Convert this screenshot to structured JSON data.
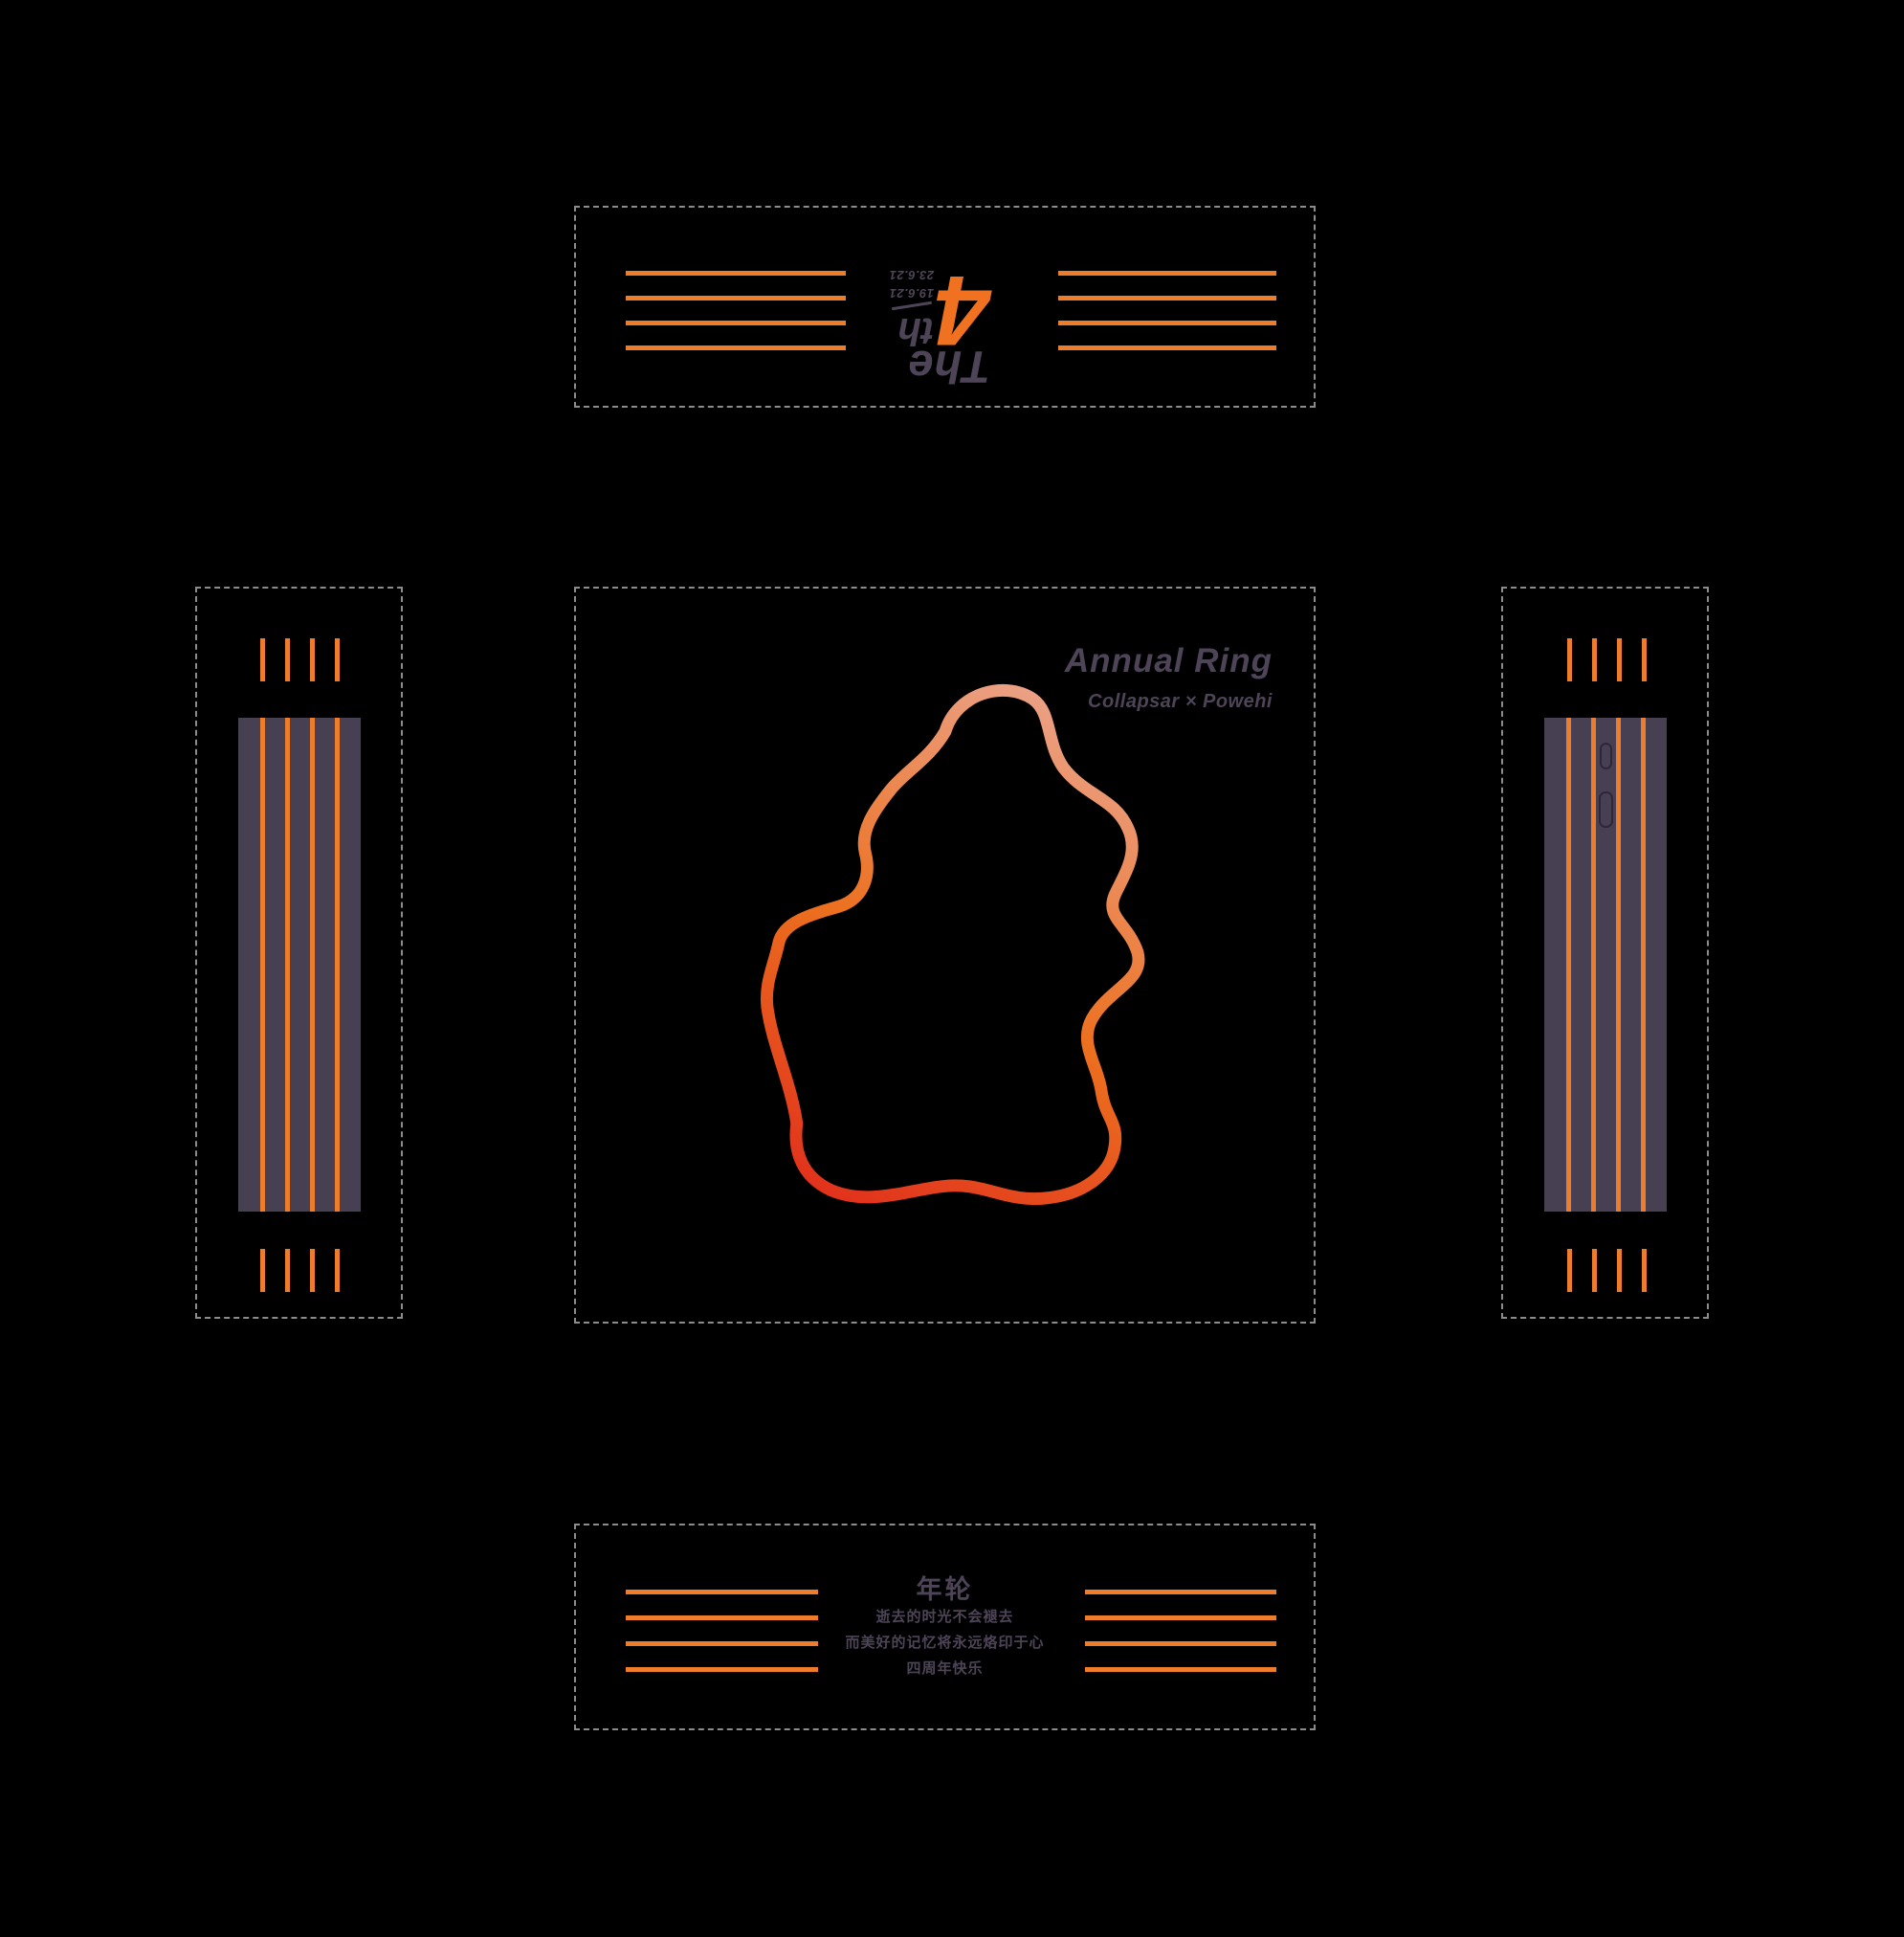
{
  "artwork": {
    "title": "Annual Ring",
    "subtitle": "Collapsar × Powehi"
  },
  "brand_flap": {
    "word": "The",
    "number": "4",
    "ordinal_suffix": "th",
    "date_from": "19.6.21",
    "date_to": "23.6.21"
  },
  "message_flap": {
    "title": "年轮",
    "lines": [
      "逝去的时光不会褪去",
      "而美好的记忆将永远烙印于心",
      "四周年快乐"
    ]
  },
  "colors": {
    "background": "#000000",
    "orange": "#ED7D2A",
    "accent_number": "#F0711F",
    "ink": "#4E4457",
    "panel_fill": "#474052",
    "dash_border": "#8C8C8C",
    "slot_outline": "#2D2837",
    "blob_gradient_top": "#EBA38A",
    "blob_gradient_mid": "#EC701F",
    "blob_gradient_bottom": "#E02C1C"
  }
}
